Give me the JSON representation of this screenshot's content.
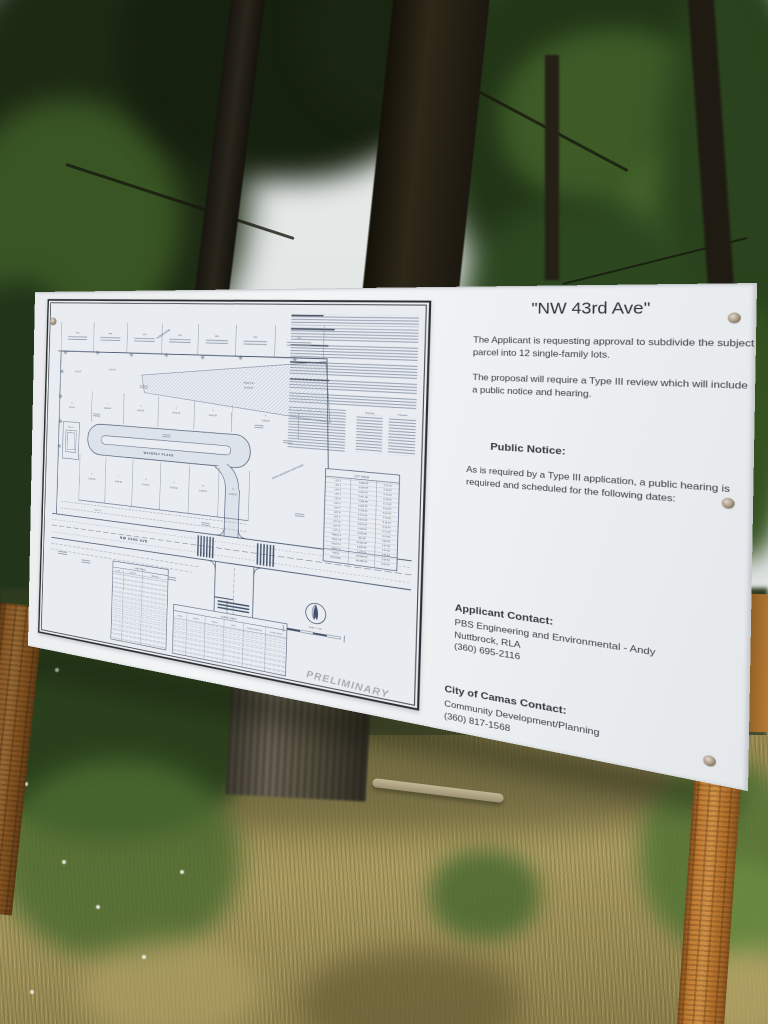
{
  "board": {
    "title": "\"NW 43rd Ave\"",
    "intro_paragraphs": [
      "The Applicant is requesting approval to subdivide the subject parcel into 12 single-family lots.",
      "The proposal will require a Type III review which will include a public notice and hearing."
    ],
    "public_notice": {
      "heading": "Public Notice:",
      "body": "As is required by a Type III application, a public hearing is required and scheduled for the following dates:"
    },
    "applicant_contact": {
      "heading": "Applicant Contact:",
      "lines": [
        "PBS Engineering and Environmental - Andy",
        "Nuttbrock, RLA",
        "(360) 695-2116"
      ]
    },
    "city_contact": {
      "heading": "City of Camas Contact:",
      "lines": [
        "Community Development/Planning",
        "(360) 817-1568"
      ]
    }
  },
  "plan_sheet": {
    "watermark": "PRELIMINARY",
    "streets": {
      "waverly": "WAVERLY PLACE",
      "avenue": "NW 43RD AVE",
      "cross": "UTAH STREET"
    },
    "north_scale": "Scale 1\" = 30'",
    "subdivision_diagonal": "SUBDIVISION",
    "sierra": "SIERRA MEADOWS SUBDIVISION",
    "neighbor_prefix": "APN",
    "tracts": {
      "a": "TRACT 'A'",
      "b": "TRACT 'B'",
      "b_sf": "16,326 SF",
      "c": "TRACT 'C'"
    },
    "upper_lots": [
      {
        "n": "1",
        "sf": "5,008 SF"
      },
      {
        "n": "2",
        "sf": "5,292 SF"
      },
      {
        "n": "3",
        "sf": "5,003 SF"
      },
      {
        "n": "4",
        "sf": "5,447 SF"
      },
      {
        "n": "5",
        "sf": "7,328 SF"
      }
    ],
    "lower_lots": [
      {
        "n": "6",
        "sf": "5,299 SF"
      },
      {
        "n": "7",
        "sf": "5,708 SF"
      },
      {
        "n": "8",
        "sf": "5,714 SF"
      },
      {
        "n": "9",
        "sf": "5,873 SF"
      },
      {
        "n": "10",
        "sf": "5,003 SF"
      },
      {
        "n": "11",
        "sf": "5,008 SF"
      }
    ],
    "west_lot": {
      "n": "12",
      "sf": "5,003 SF"
    },
    "nw_lots": [
      "5,003 SF",
      "5,008 SF"
    ],
    "lot_table": {
      "title": "LOT TABLE",
      "rows": [
        [
          "LOT 1",
          "5,008 SF",
          "0.11 AC"
        ],
        [
          "LOT 2",
          "5,292 SF",
          "0.12 AC"
        ],
        [
          "LOT 3",
          "5,003 SF",
          "0.11 AC"
        ],
        [
          "LOT 4",
          "5,447 SF",
          "0.13 AC"
        ],
        [
          "LOT 5",
          "7,328 SF",
          "0.17 AC"
        ],
        [
          "LOT 6",
          "5,299 SF",
          "0.12 AC"
        ],
        [
          "LOT 7",
          "5,708 SF",
          "0.13 AC"
        ],
        [
          "LOT 8",
          "5,714 SF",
          "0.13 AC"
        ],
        [
          "LOT 9",
          "5,873 SF",
          "0.13 AC"
        ],
        [
          "LOT 10",
          "5,003 SF",
          "0.11 AC"
        ],
        [
          "LOT 11",
          "5,008 SF",
          "0.11 AC"
        ],
        [
          "LOT 12",
          "5,003 SF",
          "0.11 AC"
        ],
        [
          "TRACT A",
          "861 SF",
          "0.02 AC"
        ],
        [
          "TRACT B",
          "16,326 SF",
          "0.37 AC"
        ],
        [
          "TRACT C",
          "4,356 SF",
          "0.10 AC"
        ],
        [
          "TRACT D",
          "2,178 SF",
          "0.05 AC"
        ],
        [
          "TOTAL",
          "140,989 SF",
          "3.24 AC"
        ],
        [
          "EXISTING",
          "140,989 SF",
          "3.24 AC"
        ]
      ]
    },
    "line_table": {
      "title": "LINE TABLE",
      "headers": [
        "LINE",
        "LENGTH",
        "BEARING"
      ]
    },
    "curve_table": {
      "title": "CURVE TABLE",
      "headers": [
        "CURVE",
        "LENGTH",
        "RADIUS",
        "DELTA",
        "CHORD DIRECTION",
        "CHORD LENGTH"
      ]
    },
    "project_info": {
      "required": "Required",
      "proposed": "Proposed"
    }
  },
  "colors": {
    "board": "#eef0f3",
    "paper": "#e9ecf1",
    "ink": "#3a3e43",
    "plan_line": "#5f6d82",
    "watermark": "#a9acae",
    "post_wood": "#b5762f",
    "foliage": "#2c4520",
    "grass": "#9c8f58"
  }
}
